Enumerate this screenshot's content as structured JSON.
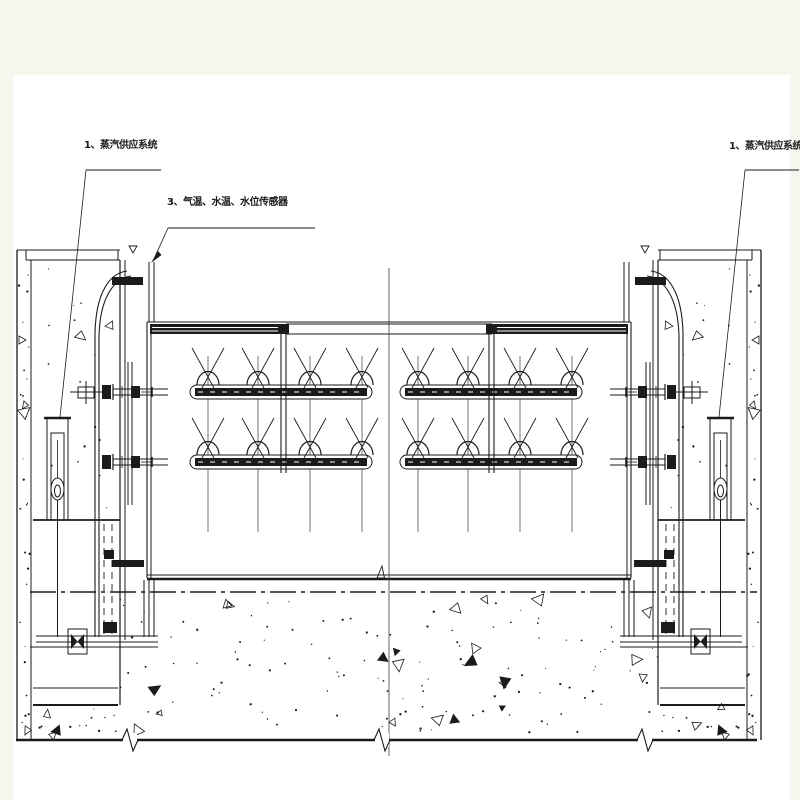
{
  "labels": {
    "steam_supply_left": "1、蒸汽供应系统",
    "sensors": "3、气温、水温、水位传感器",
    "steam_supply_right": "1、蒸汽供应系统"
  },
  "colors": {
    "background": "#f4f7ee",
    "paper": "#ffffff",
    "ink": "#1b1b1b"
  },
  "icons": {
    "spray_nozzle": "dome-with-crossed-spray-lines",
    "gate_valve": "bowtie-triangles-in-box",
    "level_marker": "inverted-triangle",
    "break_mark": "zigzag-across-line",
    "concrete_texture": "dots-and-small-triangles"
  }
}
